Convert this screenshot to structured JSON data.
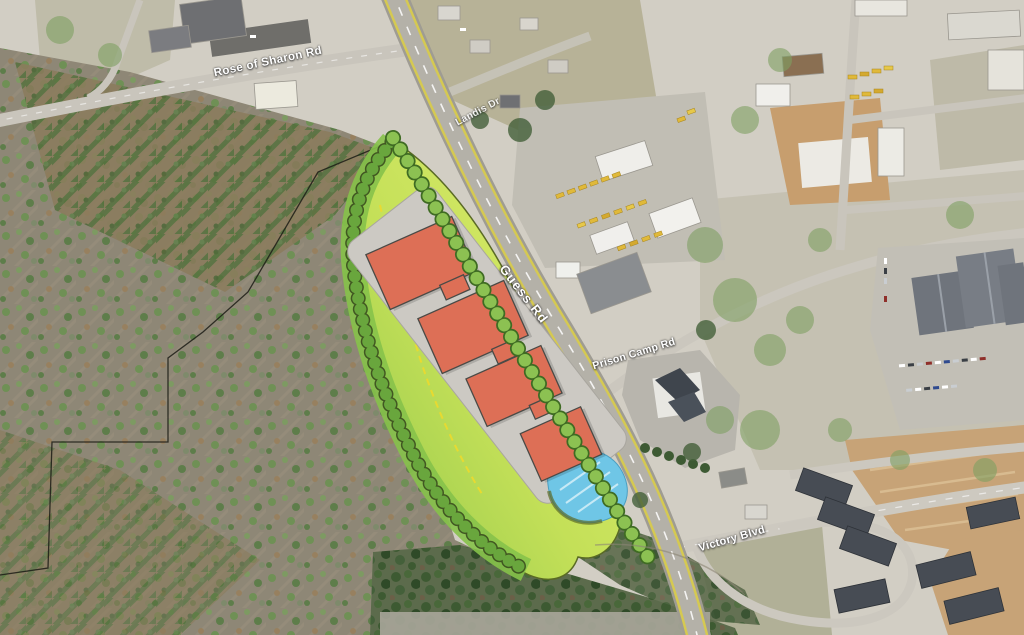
{
  "roads": [
    {
      "id": "rose-of-sharon-rd",
      "name": "Rose of Sharon Rd"
    },
    {
      "id": "landis-dr",
      "name": "Landis Dr"
    },
    {
      "id": "guess-rd",
      "name": "Guess Rd"
    },
    {
      "id": "prison-camp-rd",
      "name": "Prison Camp Rd"
    },
    {
      "id": "victory-blvd",
      "name": "Victory Blvd"
    }
  ],
  "site_plan": {
    "proposed_building_count": 4,
    "colors": {
      "building_fill": "#dd6f56",
      "building_outline": "#4a4a46",
      "building_pad": "#ccc9c3",
      "buffer_light": "#dcea67",
      "buffer_dark": "#86c24a",
      "tree_row": "#8cc152",
      "tree_row_outline": "#3f6b23",
      "pond": "#6fc6e6",
      "dashed_limit_line": "#ecd92e",
      "parcel_boundary": "#1c1c16"
    }
  },
  "base_map": {
    "colors": {
      "developed_ground": "#d2cec4",
      "forest": "#8e8776",
      "pine_rows": "#55713d",
      "conifer": "#3d5a32",
      "road": "#b4b1a8",
      "road_edge_line": "#d5c952",
      "dirt": "#c7a377",
      "equipment_yellow": "#e0b93a"
    }
  }
}
